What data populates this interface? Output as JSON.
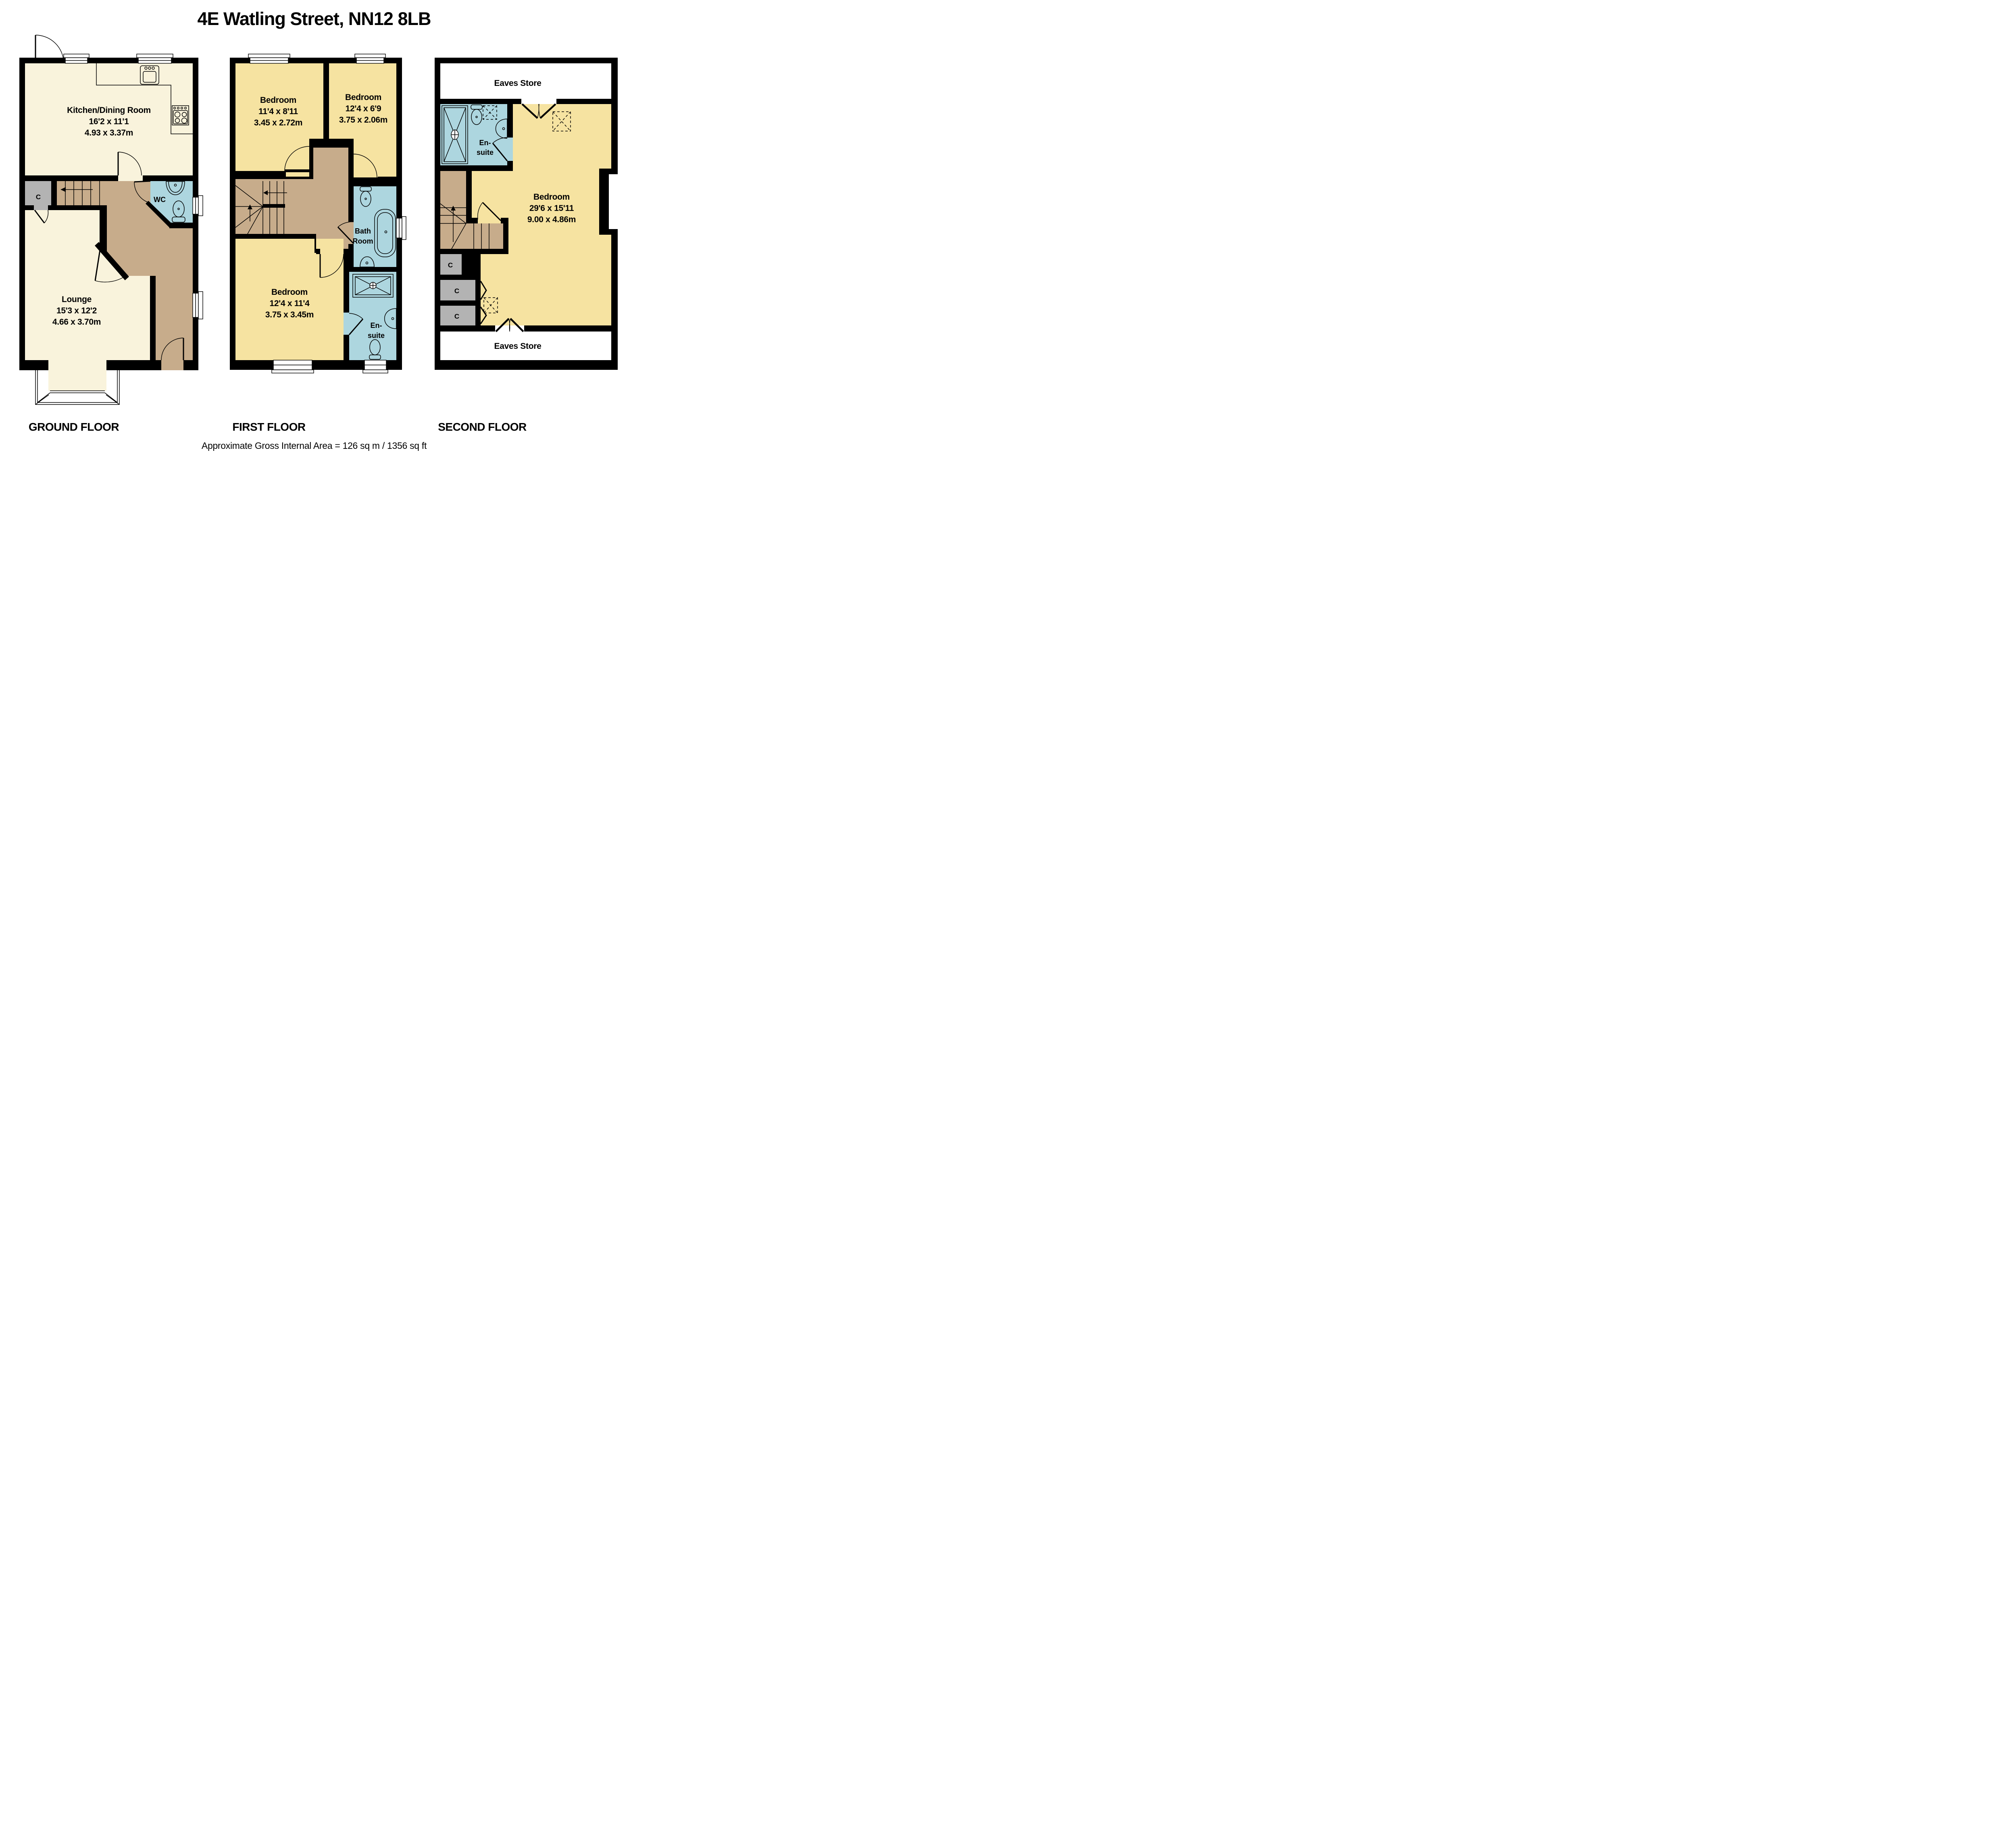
{
  "title": "4E  Watling Street, NN12 8LB",
  "footer": {
    "area_note": "Approximate Gross Internal Area = 126 sq m / 1356 sq ft"
  },
  "colors": {
    "bg": "#FFFFFF",
    "wall": "#000000",
    "cream": "#F9F3DC",
    "yellow": "#F6E3A1",
    "brown": "#C7AC8B",
    "blue": "#ADD6DF",
    "gray": "#B3B3B3"
  },
  "icons": {
    "fixtures": [
      "kitchen-sink-icon",
      "hob-icon",
      "toilet-icon",
      "basin-icon",
      "bath-icon",
      "shower-tray-icon",
      "stairs-icon",
      "door-arc-icon",
      "window-icon",
      "skylight-icon",
      "eaves-doors-icon"
    ]
  },
  "floors": [
    {
      "label": "GROUND FLOOR",
      "rooms": [
        {
          "id": "kitchen",
          "name": "Kitchen/Dining Room",
          "imperial": "16'2 x 11'1",
          "metric": "4.93 x 3.37m"
        },
        {
          "id": "lounge",
          "name": "Lounge",
          "imperial": "15'3 x 12'2",
          "metric": "4.66 x 3.70m"
        },
        {
          "id": "wc",
          "name": "WC"
        },
        {
          "id": "cupboard",
          "name": "C"
        }
      ]
    },
    {
      "label": "FIRST FLOOR",
      "rooms": [
        {
          "id": "bedroom-front",
          "name": "Bedroom",
          "imperial": "11'4 x 8'11",
          "metric": "3.45 x 2.72m"
        },
        {
          "id": "bedroom-small",
          "name": "Bedroom",
          "imperial": "12'4 x 6'9",
          "metric": "3.75 x 2.06m"
        },
        {
          "id": "bedroom-rear",
          "name": "Bedroom",
          "imperial": "12'4 x 11'4",
          "metric": "3.75 x 3.45m"
        },
        {
          "id": "bathroom",
          "name_line1": "Bath",
          "name_line2": "Room"
        },
        {
          "id": "ensuite",
          "name_line1": "En-",
          "name_line2": "suite"
        }
      ]
    },
    {
      "label": "SECOND FLOOR",
      "rooms": [
        {
          "id": "eaves-front",
          "name": "Eaves Store"
        },
        {
          "id": "ensuite",
          "name_line1": "En-",
          "name_line2": "suite"
        },
        {
          "id": "bedroom-master",
          "name": "Bedroom",
          "imperial": "29'6 x 15'11",
          "metric": "9.00 x 4.86m"
        },
        {
          "id": "cupboard-1",
          "name": "C"
        },
        {
          "id": "cupboard-2",
          "name": "C"
        },
        {
          "id": "cupboard-3",
          "name": "C"
        },
        {
          "id": "eaves-rear",
          "name": "Eaves Store"
        }
      ]
    }
  ]
}
